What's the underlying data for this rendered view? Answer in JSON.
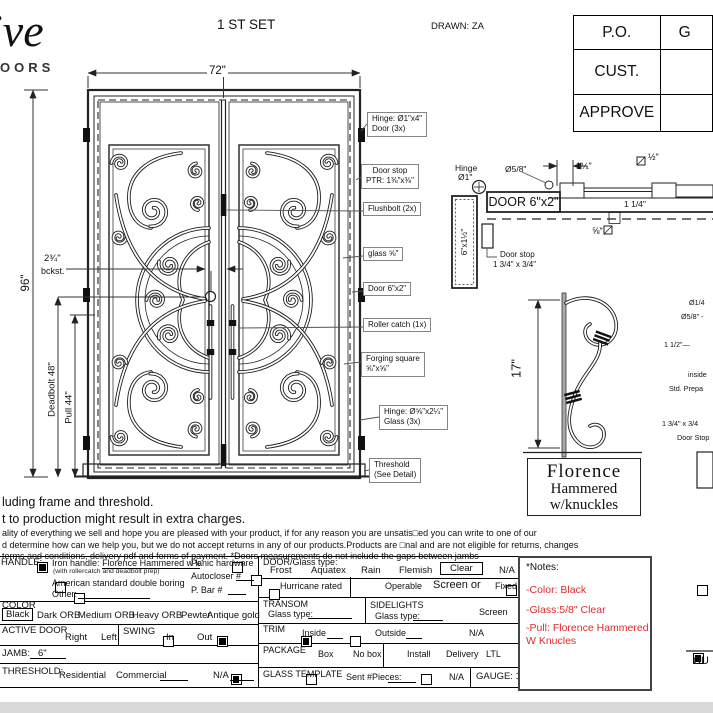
{
  "colors": {
    "accent_red": "#e02b2b",
    "line": "#1a1a1a"
  },
  "header": {
    "logo_script": "ive",
    "logo_word": "OORS",
    "set_label": "1 ST SET",
    "drawn": "DRAWN: ZA",
    "table": {
      "rows": [
        {
          "label": "P.O.",
          "value": "G"
        },
        {
          "label": "CUST.",
          "value": ""
        },
        {
          "label": "APPROVE",
          "value": ""
        }
      ]
    }
  },
  "drawing": {
    "dim_width": "72\"",
    "dim_height": "96\"",
    "backset": "2¾\"",
    "backset_sub": "bckst.",
    "deadbolt": "Deadbolt 48\"",
    "pull": "Pull 44\"",
    "callouts": [
      {
        "line1": "Hinge: Ø1\"x4\"",
        "line2": "Door (3x)"
      },
      {
        "line1": "Door stop",
        "line2": "PTR: 1⅜\"x⅜\""
      },
      {
        "line1": "Flushbolt (2x)",
        "line2": ""
      },
      {
        "line1": "glass ⅝\"",
        "line2": ""
      },
      {
        "line1": "Door  6\"x2\"",
        "line2": ""
      },
      {
        "line1": "Roller catch  (1x)",
        "line2": ""
      },
      {
        "line1": "Forging square",
        "line2": "⅝\"x⅝\""
      },
      {
        "line1": "Hinge: Ø⅝\"x2¼\"",
        "line2": "Glass (3x)"
      },
      {
        "line1": "Threshold",
        "line2": "(See Detail)"
      }
    ]
  },
  "section": {
    "hinge_line1": "Hinge",
    "hinge_line2": "Ø1\"",
    "door_box": "DOOR 6\"x2\"",
    "jamb_size": "6\"x1½\"",
    "dia58": "Ø5/8\"",
    "dim_125": "1¼\"",
    "sq_half": "½\"",
    "dim_114": "1 1/4\"",
    "sq_58": "⅝\"",
    "stop_line1": "Door stop",
    "stop_line2": "1 3/4\" x 3/4\""
  },
  "handle_detail": {
    "dim": "17\"",
    "side_notes": [
      "Ø1/4",
      "Ø5/8\" -",
      "1 1/2\"—",
      "inside",
      "Std. Prepa",
      "1 3/4\" x 3/4",
      "Door Stop"
    ]
  },
  "florence": {
    "line1": "Florence",
    "line2": "Hammered",
    "line3": "w/knuckles"
  },
  "disclaimer": {
    "line1": "luding frame and threshold.",
    "line2": "t to production might result in extra charges.",
    "line3": "ality of everything we sell and hope you are pleased with your product, if for any reason you are unsatis□ed you can write to one of our",
    "line4": "d determine how can we help you, but we do not accept returns in any of our products.Products are □nal and are not eligible for returns, changes",
    "line5": "terms and conditions, delivery pdf and forms of payment. *Doors measurements do not include the gaps between jambs"
  },
  "form": {
    "handle_label": "HANDLE:",
    "iron_handle": "Iron handle:",
    "iron_handle_u": "Florence  Hammered w k",
    "iron_handle_sub": "(with rollercatch and deadbolt prep)",
    "iron_checked": true,
    "american": "American standard double boring",
    "american_checked": false,
    "other": "Other:",
    "other_checked": false,
    "panic": "Panic hardware",
    "panic_checked": false,
    "autocloser": "Autocloser #",
    "autocloser_checked": false,
    "pbar": "P. Bar #",
    "pbar_checked": false,
    "color_label": "COLOR",
    "color_options": [
      "Black",
      "Dark ORB",
      "Medium ORB",
      "Heavy ORB",
      "Pewter",
      "Antique gold"
    ],
    "color_selected": "Black",
    "active_label": "ACTIVE DOOR",
    "right": "Right",
    "right_checked": false,
    "left": "Left",
    "left_checked": true,
    "swing_label": "SWING",
    "in": "In",
    "in_checked": true,
    "out": "Out",
    "out_checked": false,
    "jamb_label": "JAMB:",
    "jamb_value": "6\"",
    "threshold_label": "THRESHOLD:",
    "residential": "Residential",
    "residential_checked": true,
    "commercial": "Commercial",
    "commercial_checked": false,
    "thresh_na": "N/A",
    "thresh_na_checked": false,
    "doorglass_label": "DOOR/Glass type:",
    "glass_options": [
      "Frost",
      "Aquatex",
      "Rain",
      "Flemish",
      "Clear",
      "N/A"
    ],
    "glass_selected": "Clear",
    "hurricane": "Hurricane rated",
    "hurricane_checked": false,
    "operable": "Operable",
    "operable_checked": true,
    "screen_or": "Screen or",
    "screen_or_checked": false,
    "fixed": "Fixed",
    "fixed_checked": false,
    "transom_label": "TRANSOM",
    "transom_glass": "Glass type:",
    "sidelights_label": "SIDELIGHTS",
    "sidelights_glass": "Glass type:",
    "screen": "Screen",
    "screen_checked": false,
    "trim_label": "TRIM",
    "inside": "Inside",
    "inside_checked": false,
    "outside": "Outside",
    "outside_checked": false,
    "trim_na": "N/A",
    "trim_na_checked": true,
    "package_label": "PACKAGE",
    "box": "Box",
    "box_checked": true,
    "no_box": "No box",
    "no_box_checked": false,
    "install": "Install",
    "install_checked": false,
    "delivery": "Delivery",
    "delivery_checked": false,
    "ltl": "LTL",
    "ltl_checked": true,
    "template_label": "GLASS TEMPLATE",
    "sent": "Sent #Pieces:",
    "sent_checked": false,
    "template_na": "N/A",
    "template_na_checked": false,
    "gauge": "GAUGE: 14"
  },
  "notes": {
    "title": "*Notes:",
    "items": [
      "-Color: Black",
      "-Glass:5/8\"   Clear",
      "-Pull: Florence Hammered",
      "W Knucles"
    ]
  },
  "signature": "CU"
}
